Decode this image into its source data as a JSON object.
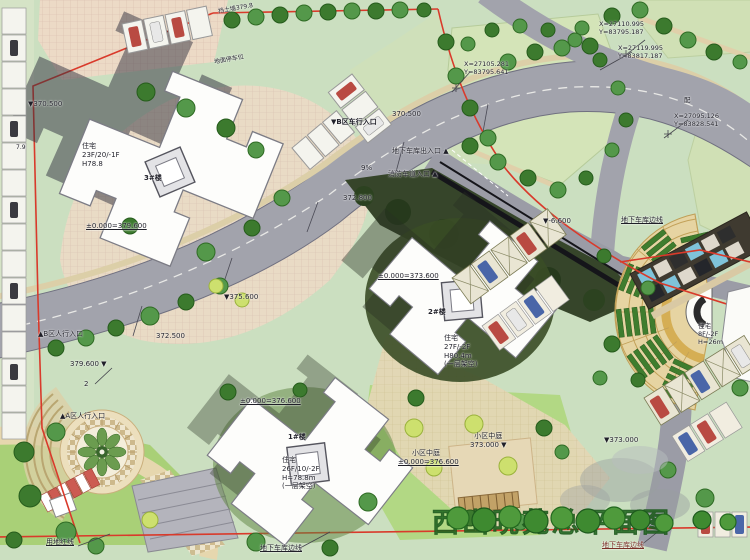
{
  "title": "西山晓苑总平面图",
  "colors": {
    "boundary_red": "#d93a2b",
    "road_gray": "#a2a3ac",
    "lawn_green": "#b5d98a",
    "tree_green": "#4e8f3c",
    "title_green": "#2f7d2b"
  },
  "buildings": {
    "b1": {
      "label": "1#楼",
      "info": "住宅\n26F/10/-2F\nH=78.8m\n(一层架空)",
      "elevation": "±0.000=376.600"
    },
    "b2": {
      "label": "2#楼",
      "info": "住宅\n27F/-2F\nH80.4m\n(一层架空)",
      "elevation": "±0.000=373.600"
    },
    "b3": {
      "label": "3#楼",
      "info": "住宅\n23F/20/-1F\nH78.8",
      "elevation": "±0.000=379.600"
    },
    "b8f": {
      "info": "住宅\n8F/-2F\nH=26m"
    }
  },
  "entrances": {
    "vehicle_b": "▼B区车行入口",
    "garage_exit": "地下车库出入口 ▲",
    "fire_lane": "消防车道入口 ▲",
    "ped_b": "▲B区人行入口",
    "ped_a": "▲A区人行入口"
  },
  "elevations": {
    "e370_top": "▼370.500",
    "e370_road": "370.500",
    "e372_8": "372.800",
    "e379_6": "379.600 ▼",
    "e375_6": "▼375.600",
    "e372_5": "372.500",
    "e6_6": "▼-6.600",
    "e373_0": "▼373.000",
    "atrium_a": "小区中庭\n373.000 ▼",
    "atrium_b": "小区中庭",
    "e376_6": "±0.000=376.600"
  },
  "coordinates": {
    "c1": "X=27110.995\nY=83795.187",
    "c2": "X=27105.281\nY=83795.641",
    "c3": "X=27119.995\nY=83817.187",
    "c4": "X=27095.126\nY=83828.541"
  },
  "annotations": {
    "red_line": "用地红线",
    "garage_edge": "地下车库边线",
    "wall_note": "挡土墙379.8",
    "parking_note": "地面停车位",
    "slope": "9%",
    "road_num": "2",
    "dim_79": "7.9",
    "distribution": "配"
  }
}
